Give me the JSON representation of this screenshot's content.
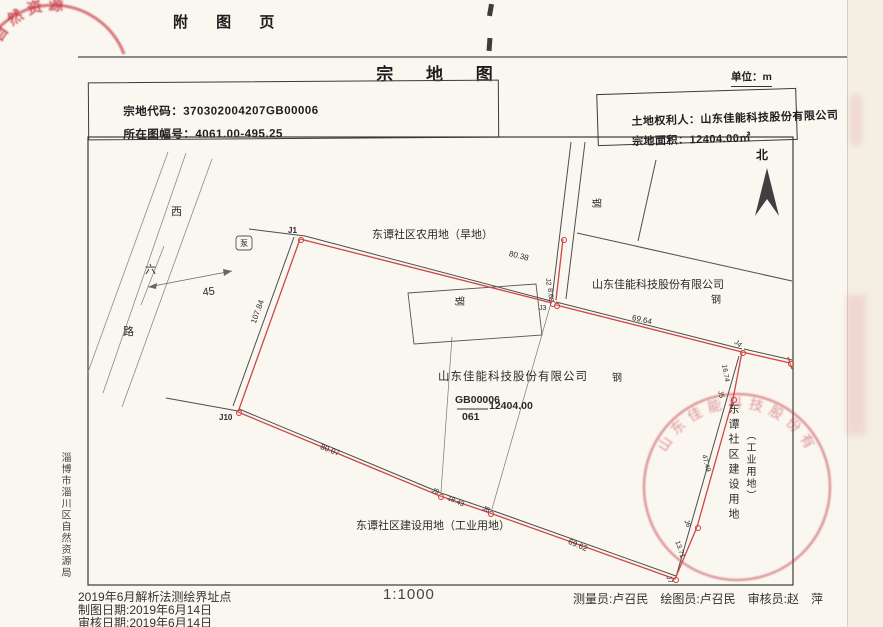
{
  "page": {
    "attachment_header": "附 图 页",
    "title": "宗 地 图",
    "unit": "单位：m",
    "north": "北",
    "fields": {
      "parcel_code_label": "宗地代码：",
      "parcel_code": "370302004207GB00006",
      "sheet_no_label": "所在图幅号：",
      "sheet_no": "4061.00-495.25",
      "owner_label": "土地权利人：",
      "owner": "山东佳能科技股份有限公司",
      "area_label": "宗地面积：",
      "area": "12404.00㎡"
    },
    "scale": "1:1000",
    "footer_left": [
      "2019年6月解析法测绘界址点",
      "制图日期:2019年6月14日",
      "审核日期:2019年6月14日"
    ],
    "footer_right": "测量员:卢召民　绘图员:卢召民　审核员:赵　萍",
    "side_agency": "淄博市淄川区自然资源局"
  },
  "stamps": {
    "top_left_text": "区自然资源",
    "bottom_right_text": "山东佳能科技股份有限公司"
  },
  "map": {
    "labels": [
      {
        "id": "neighbor-top-label",
        "text": "东谭社区农用地（旱地）",
        "x": 372,
        "y": 230,
        "size": 11
      },
      {
        "id": "edge-length-80-38",
        "text": "80.38",
        "x": 510,
        "y": 250,
        "size": 8,
        "rot": 14
      },
      {
        "id": "point-j1",
        "text": "J1",
        "x": 288,
        "y": 227,
        "size": 8,
        "bold": 1
      },
      {
        "id": "pump-symbol",
        "text": "泵",
        "x": 240,
        "y": 240,
        "size": 8
      },
      {
        "id": "road-char-west",
        "text": "西",
        "x": 171,
        "y": 207,
        "size": 11
      },
      {
        "id": "road-char-six",
        "text": "六",
        "x": 145,
        "y": 265,
        "size": 11
      },
      {
        "id": "road-char-lu",
        "text": "路",
        "x": 123,
        "y": 327,
        "size": 11
      },
      {
        "id": "road-width-45",
        "text": "45",
        "x": 202,
        "y": 288,
        "size": 11,
        "rot": -8
      },
      {
        "id": "edge-length-107-84",
        "text": "107.84",
        "x": 250,
        "y": 322,
        "size": 8,
        "rot": -70
      },
      {
        "id": "point-j10",
        "text": "J10",
        "x": 219,
        "y": 414,
        "size": 8,
        "bold": 1
      },
      {
        "id": "edge-length-80-07",
        "text": "80.07",
        "x": 322,
        "y": 443,
        "size": 8,
        "rot": 22
      },
      {
        "id": "point-j9",
        "text": "J9",
        "x": 433,
        "y": 487,
        "size": 7,
        "rot": 22
      },
      {
        "id": "edge-length-18-43",
        "text": "18.43",
        "x": 449,
        "y": 495,
        "size": 7,
        "rot": 24
      },
      {
        "id": "point-j8",
        "text": "J8",
        "x": 484,
        "y": 505,
        "size": 7,
        "rot": 24
      },
      {
        "id": "edge-length-69-62",
        "text": "69.62",
        "x": 570,
        "y": 538,
        "size": 8,
        "rot": 23
      },
      {
        "id": "point-j7",
        "text": "J7",
        "x": 671,
        "y": 575,
        "size": 7,
        "rot": 70
      },
      {
        "id": "edge-length-13-71",
        "text": "13.71",
        "x": 680,
        "y": 540,
        "size": 7,
        "rot": 72
      },
      {
        "id": "point-j6",
        "text": "J6",
        "x": 689,
        "y": 519,
        "size": 7,
        "rot": 70
      },
      {
        "id": "edge-length-47-49",
        "text": "47.49",
        "x": 707,
        "y": 454,
        "size": 7,
        "rot": 76
      },
      {
        "id": "point-j5",
        "text": "J5",
        "x": 723,
        "y": 390,
        "size": 7,
        "rot": 76
      },
      {
        "id": "edge-length-16-74",
        "text": "16.74",
        "x": 727,
        "y": 364,
        "size": 7,
        "rot": 80
      },
      {
        "id": "point-j4",
        "text": "J4",
        "x": 737,
        "y": 339,
        "size": 7,
        "rot": 40
      },
      {
        "id": "edge-length-69-64",
        "text": "69.64",
        "x": 633,
        "y": 314,
        "size": 8,
        "rot": 13
      },
      {
        "id": "point-j2",
        "text": "J2",
        "x": 551,
        "y": 278,
        "size": 7,
        "rot": 85
      },
      {
        "id": "edge-length-8-68",
        "text": "8.68",
        "x": 553,
        "y": 288,
        "size": 7,
        "rot": 85
      },
      {
        "id": "point-j3",
        "text": "J3",
        "x": 539,
        "y": 305,
        "size": 7
      },
      {
        "id": "neighbor-company-label",
        "text": "山东佳能科技股份有限公司",
        "x": 592,
        "y": 280,
        "size": 11
      },
      {
        "id": "building-steel-1",
        "text": "钢",
        "x": 600,
        "y": 198,
        "size": 10,
        "rot": 90
      },
      {
        "id": "building-steel-2",
        "text": "钢",
        "x": 711,
        "y": 296,
        "size": 10
      },
      {
        "id": "building-steel-3",
        "text": "钢",
        "x": 463,
        "y": 296,
        "size": 10,
        "rot": 90
      },
      {
        "id": "building-steel-4",
        "text": "钢",
        "x": 612,
        "y": 374,
        "size": 10
      },
      {
        "id": "parcel-owner-label",
        "text": "山东佳能科技股份有限公司",
        "x": 438,
        "y": 372,
        "size": 11.5,
        "ls": 1
      },
      {
        "id": "parcel-code-numerator",
        "text": "GB00006",
        "x": 455,
        "y": 395,
        "size": 10.5,
        "bold": 1
      },
      {
        "id": "parcel-code-denominator",
        "text": "061",
        "x": 462,
        "y": 412,
        "size": 10.5,
        "bold": 1
      },
      {
        "id": "parcel-area-value",
        "text": "12404.00",
        "x": 489,
        "y": 401,
        "size": 10.5,
        "bold": 1
      },
      {
        "id": "neighbor-bottom-label",
        "text": "东谭社区建设用地（工业用地）",
        "x": 356,
        "y": 521,
        "size": 11
      },
      {
        "id": "east-use-label-col1",
        "text": "东谭社区建设用地",
        "x": 727,
        "y": 403,
        "size": 11,
        "vert": 1,
        "ls": 4
      },
      {
        "id": "east-use-label-col2",
        "text": "（工业用地）",
        "x": 744,
        "y": 430,
        "size": 10,
        "vert": 1,
        "ls": 2
      }
    ],
    "vertices": [
      [
        300,
        239
      ],
      [
        552,
        303
      ],
      [
        556,
        305
      ],
      [
        742,
        352
      ],
      [
        733,
        399
      ],
      [
        697,
        527
      ],
      [
        675,
        579
      ],
      [
        490,
        513
      ],
      [
        440,
        496
      ],
      [
        238,
        412
      ],
      [
        563,
        239
      ],
      [
        790,
        363
      ]
    ]
  }
}
